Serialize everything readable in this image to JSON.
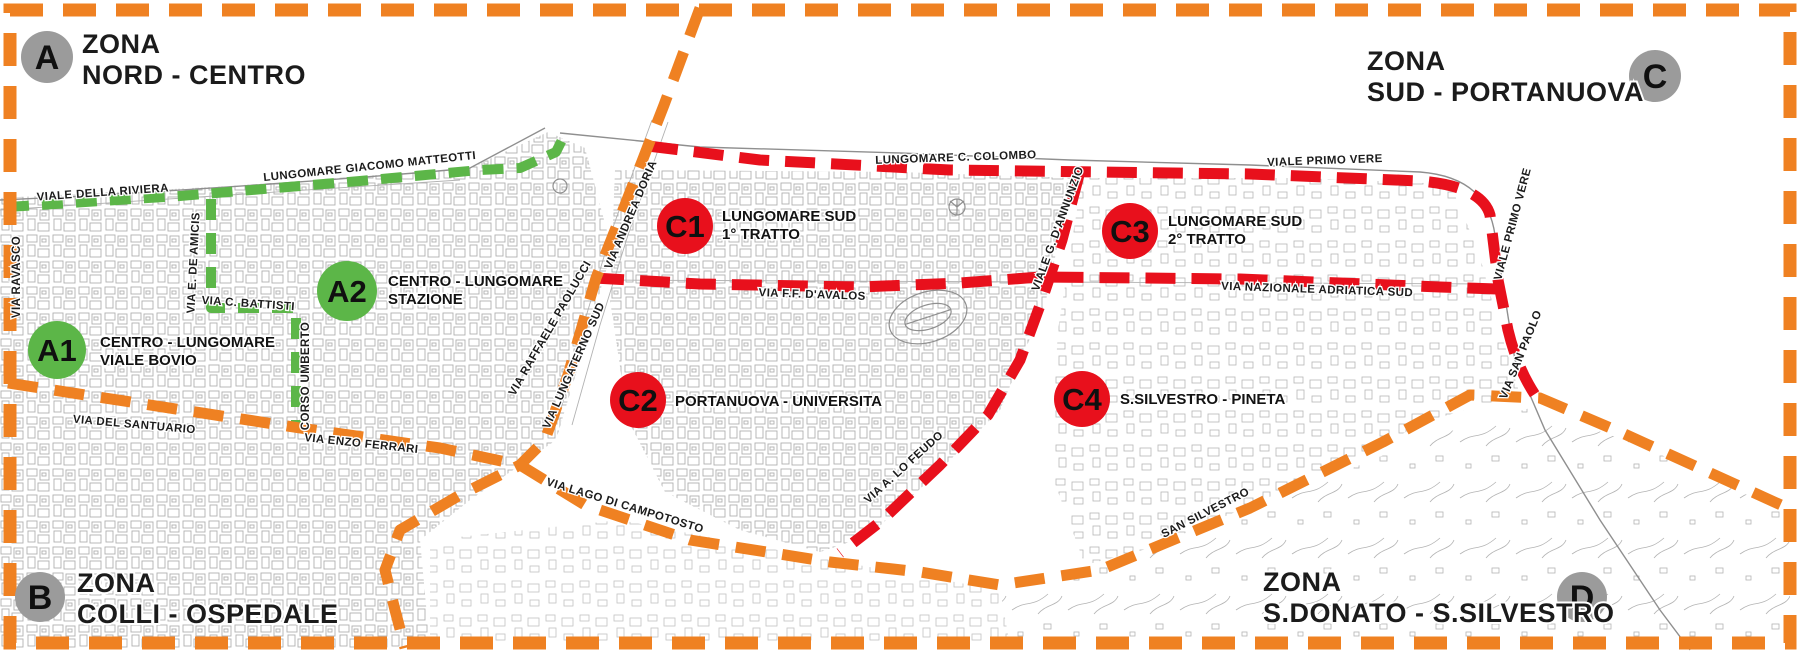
{
  "colors": {
    "orange": "#EF8122",
    "green": "#5CB648",
    "red": "#E8101C",
    "zone_gray": "#9B9B9B",
    "ink": "#1B1B1B",
    "map_line": "#8F8F8F"
  },
  "zones": [
    {
      "id": "A",
      "letter": "A",
      "title_line1": "ZONA",
      "title_line2": "NORD - CENTRO"
    },
    {
      "id": "B",
      "letter": "B",
      "title_line1": "ZONA",
      "title_line2": "COLLI - OSPEDALE"
    },
    {
      "id": "C",
      "letter": "C",
      "title_line1": "ZONA",
      "title_line2": "SUD - PORTANUOVA"
    },
    {
      "id": "D",
      "letter": "D",
      "title_line1": "ZONA",
      "title_line2": "S.DONATO - S.SILVESTRO"
    }
  ],
  "subzones": [
    {
      "id": "A1",
      "label": "A1",
      "name_line1": "CENTRO - LUNGOMARE",
      "name_line2": "VIALE BOVIO",
      "color": "green"
    },
    {
      "id": "A2",
      "label": "A2",
      "name_line1": "CENTRO - LUNGOMARE",
      "name_line2": "STAZIONE",
      "color": "green"
    },
    {
      "id": "C1",
      "label": "C1",
      "name_line1": "LUNGOMARE SUD",
      "name_line2": "1° TRATTO",
      "color": "red"
    },
    {
      "id": "C2",
      "label": "C2",
      "name_line1": "PORTANUOVA - UNIVERSITA",
      "name_line2": "",
      "color": "red"
    },
    {
      "id": "C3",
      "label": "C3",
      "name_line1": "LUNGOMARE SUD",
      "name_line2": "2° TRATTO",
      "color": "red"
    },
    {
      "id": "C4",
      "label": "C4",
      "name_line1": "S.SILVESTRO - PINETA",
      "name_line2": "",
      "color": "red"
    }
  ],
  "streets": [
    {
      "label": "VIALE DELLA RIVIERA"
    },
    {
      "label": "LUNGOMARE GIACOMO MATTEOTTI"
    },
    {
      "label": "LUNGOMARE C. COLOMBO"
    },
    {
      "label": "VIALE PRIMO VERE"
    },
    {
      "label": "VIALE PRIMO VERE"
    },
    {
      "label": "VIA SAN PAOLO"
    },
    {
      "label": "VIA RAVASCO"
    },
    {
      "label": "VIA E. DE AMICIS"
    },
    {
      "label": "VIA C. BATTISTI"
    },
    {
      "label": "CORSO UMBERTO"
    },
    {
      "label": "VIA ANDREA DORIA"
    },
    {
      "label": "VIA RAFFAELE PAOLUCCI"
    },
    {
      "label": "VIA LUNGATERNO SUD"
    },
    {
      "label": "VIA F.F. D'AVALOS"
    },
    {
      "label": "VIA NAZIONALE ADRIATICA SUD"
    },
    {
      "label": "VIALE G. D'ANNUNZIO"
    },
    {
      "label": "VIA DEL SANTUARIO"
    },
    {
      "label": "VIA ENZO FERRARI"
    },
    {
      "label": "VIA LAGO DI CAMPOTOSTO"
    },
    {
      "label": "VIA A. LO FEUDO"
    },
    {
      "label": "SAN SILVESTRO"
    }
  ]
}
